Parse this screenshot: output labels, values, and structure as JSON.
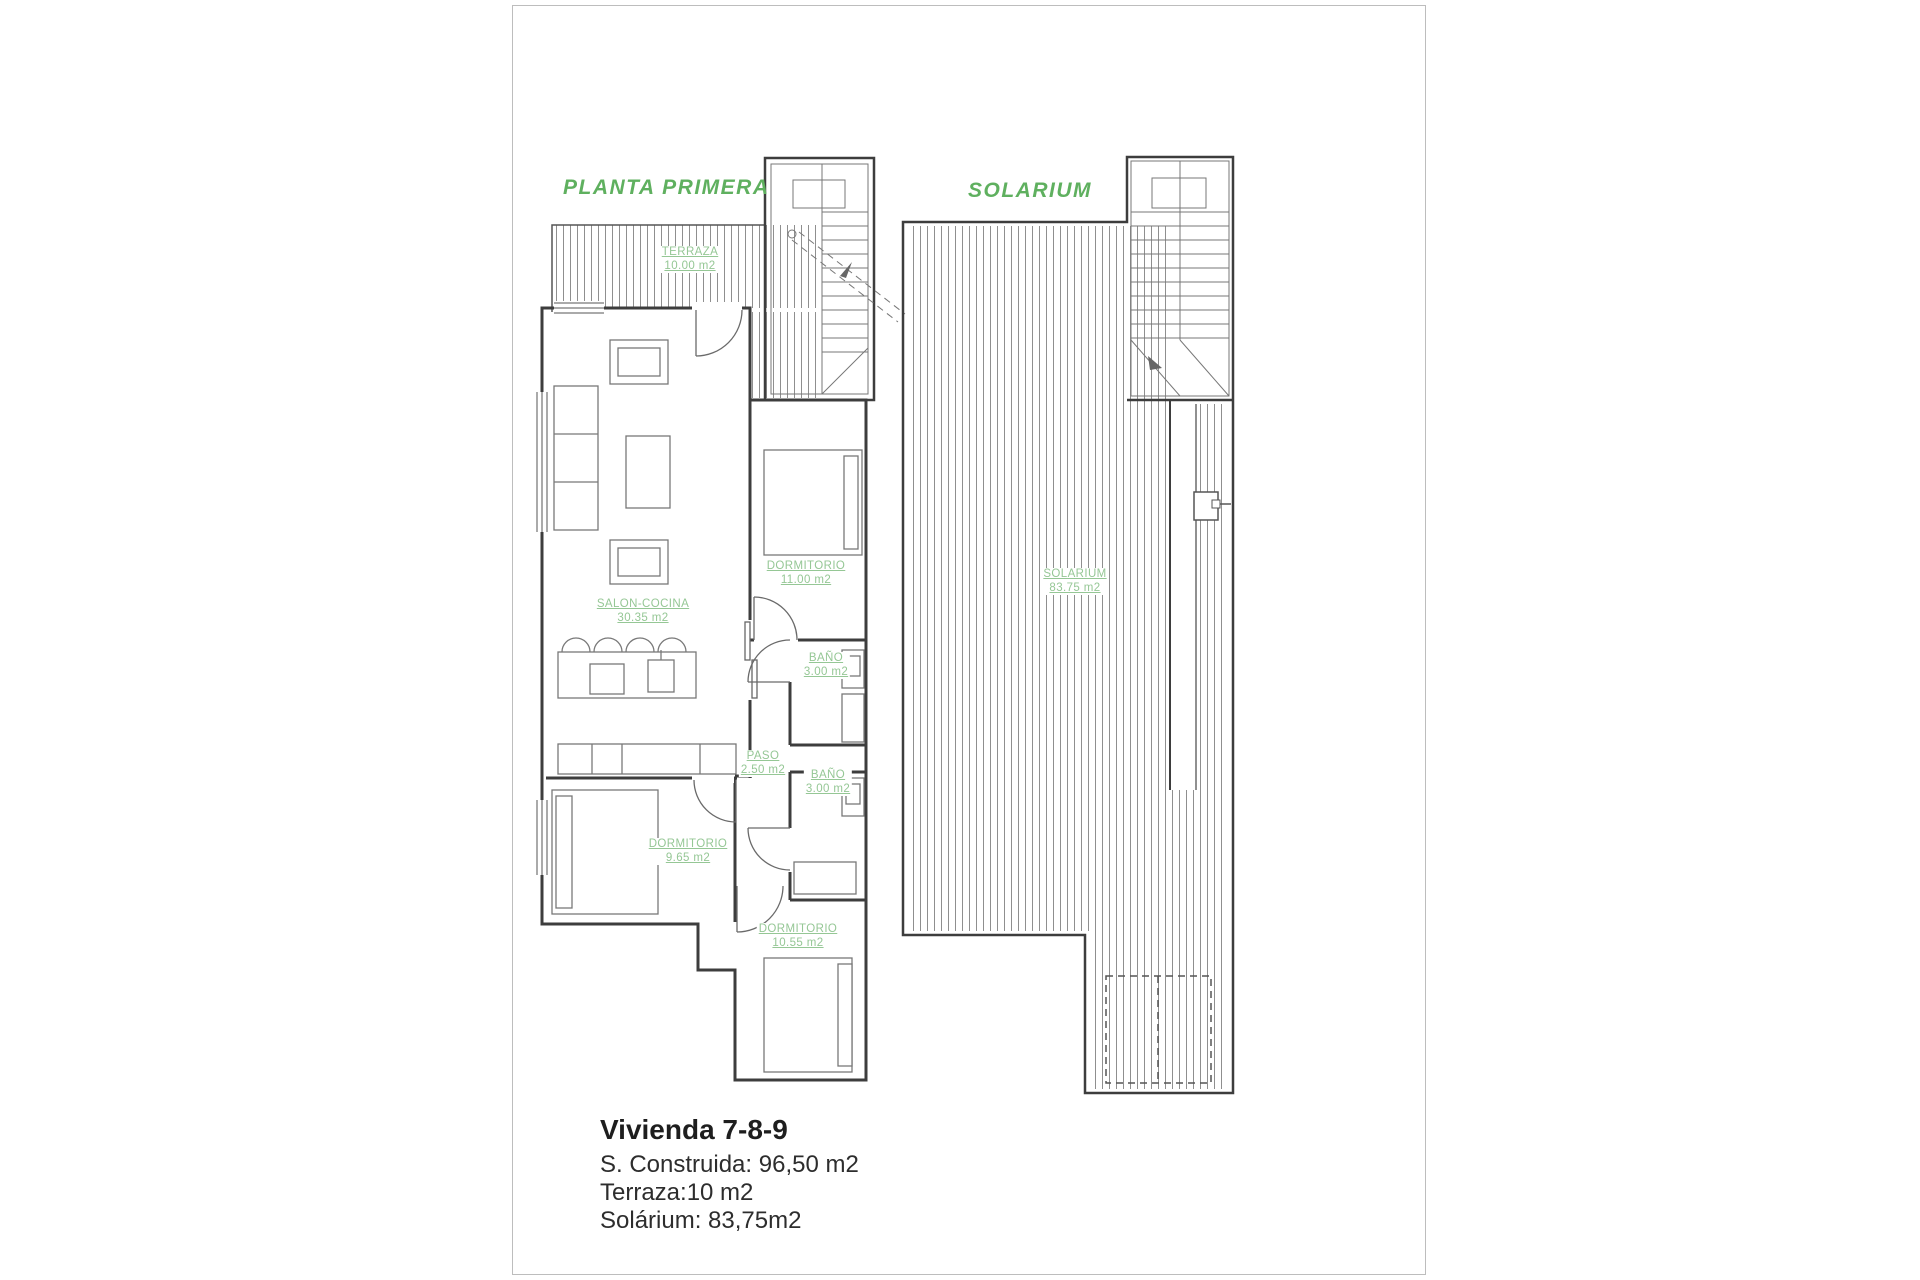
{
  "colors": {
    "title_green": "#5fb05f",
    "label_green": "#95c795",
    "wall": "#3d3d3d",
    "hatch": "#8f8f8f",
    "page_border": "#bdbdbd"
  },
  "plans": {
    "planta_primera": {
      "title": "PLANTA PRIMERA",
      "rooms": [
        {
          "id": "terraza",
          "name": "TERRAZA",
          "area": "10.00 m2"
        },
        {
          "id": "salon",
          "name": "SALON-COCINA",
          "area": "30.35 m2"
        },
        {
          "id": "dorm11",
          "name": "DORMITORIO",
          "area": "11.00 m2"
        },
        {
          "id": "bano1",
          "name": "BAÑO",
          "area": "3.00 m2"
        },
        {
          "id": "paso",
          "name": "PASO",
          "area": "2.50 m2"
        },
        {
          "id": "bano2",
          "name": "BAÑO",
          "area": "3.00 m2"
        },
        {
          "id": "dorm965",
          "name": "DORMITORIO",
          "area": "9.65 m2"
        },
        {
          "id": "dorm1055",
          "name": "DORMITORIO",
          "area": "10.55 m2"
        }
      ]
    },
    "solarium": {
      "title": "SOLARIUM",
      "rooms": [
        {
          "id": "solarium",
          "name": "SOLARIUM",
          "area": "83.75 m2"
        }
      ]
    }
  },
  "summary": {
    "title": "Vivienda 7-8-9",
    "lines": [
      "S. Construida: 96,50 m2",
      "Terraza:10 m2",
      "Solárium: 83,75m2"
    ]
  }
}
